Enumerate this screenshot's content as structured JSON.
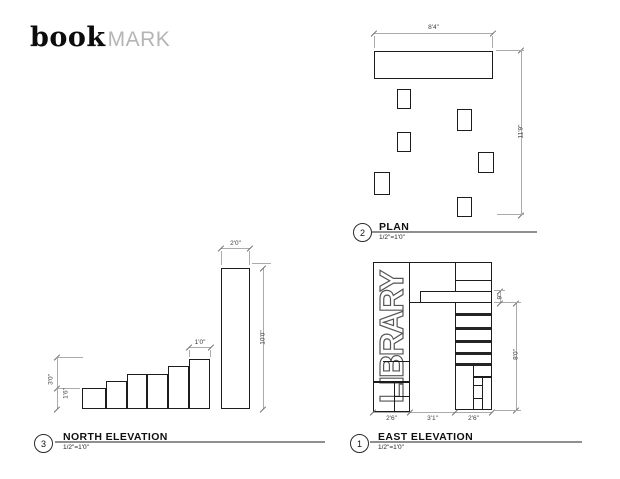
{
  "logo": {
    "bold": "book",
    "light": "MARK"
  },
  "colors": {
    "line": "#1c1c1c",
    "dim_line": "#ababab",
    "label_line": "#8f8f8f",
    "logo_gray": "#b5b5b5"
  },
  "plan": {
    "number": "2",
    "title": "PLAN",
    "scale": "1/2\"=1'0\"",
    "dims": {
      "width": "8'4\"",
      "depth": "11'9\""
    }
  },
  "north": {
    "number": "3",
    "title": "NORTH ELEVATION",
    "scale": "1/2\"=1'0\"",
    "dims": {
      "col_w": "2'0\"",
      "step_w": "1'0\"",
      "col_h": "10'0\"",
      "h3": "3'0\"",
      "h1": "1'6\""
    }
  },
  "east": {
    "number": "1",
    "title": "EAST ELEVATION",
    "scale": "1/2\"=1'0\"",
    "library": "LIBRARY",
    "dims": {
      "w1": "2'6\"",
      "w2": "3'1\"",
      "w3": "2'6\"",
      "h": "8'0\"",
      "plank": "9\""
    }
  }
}
